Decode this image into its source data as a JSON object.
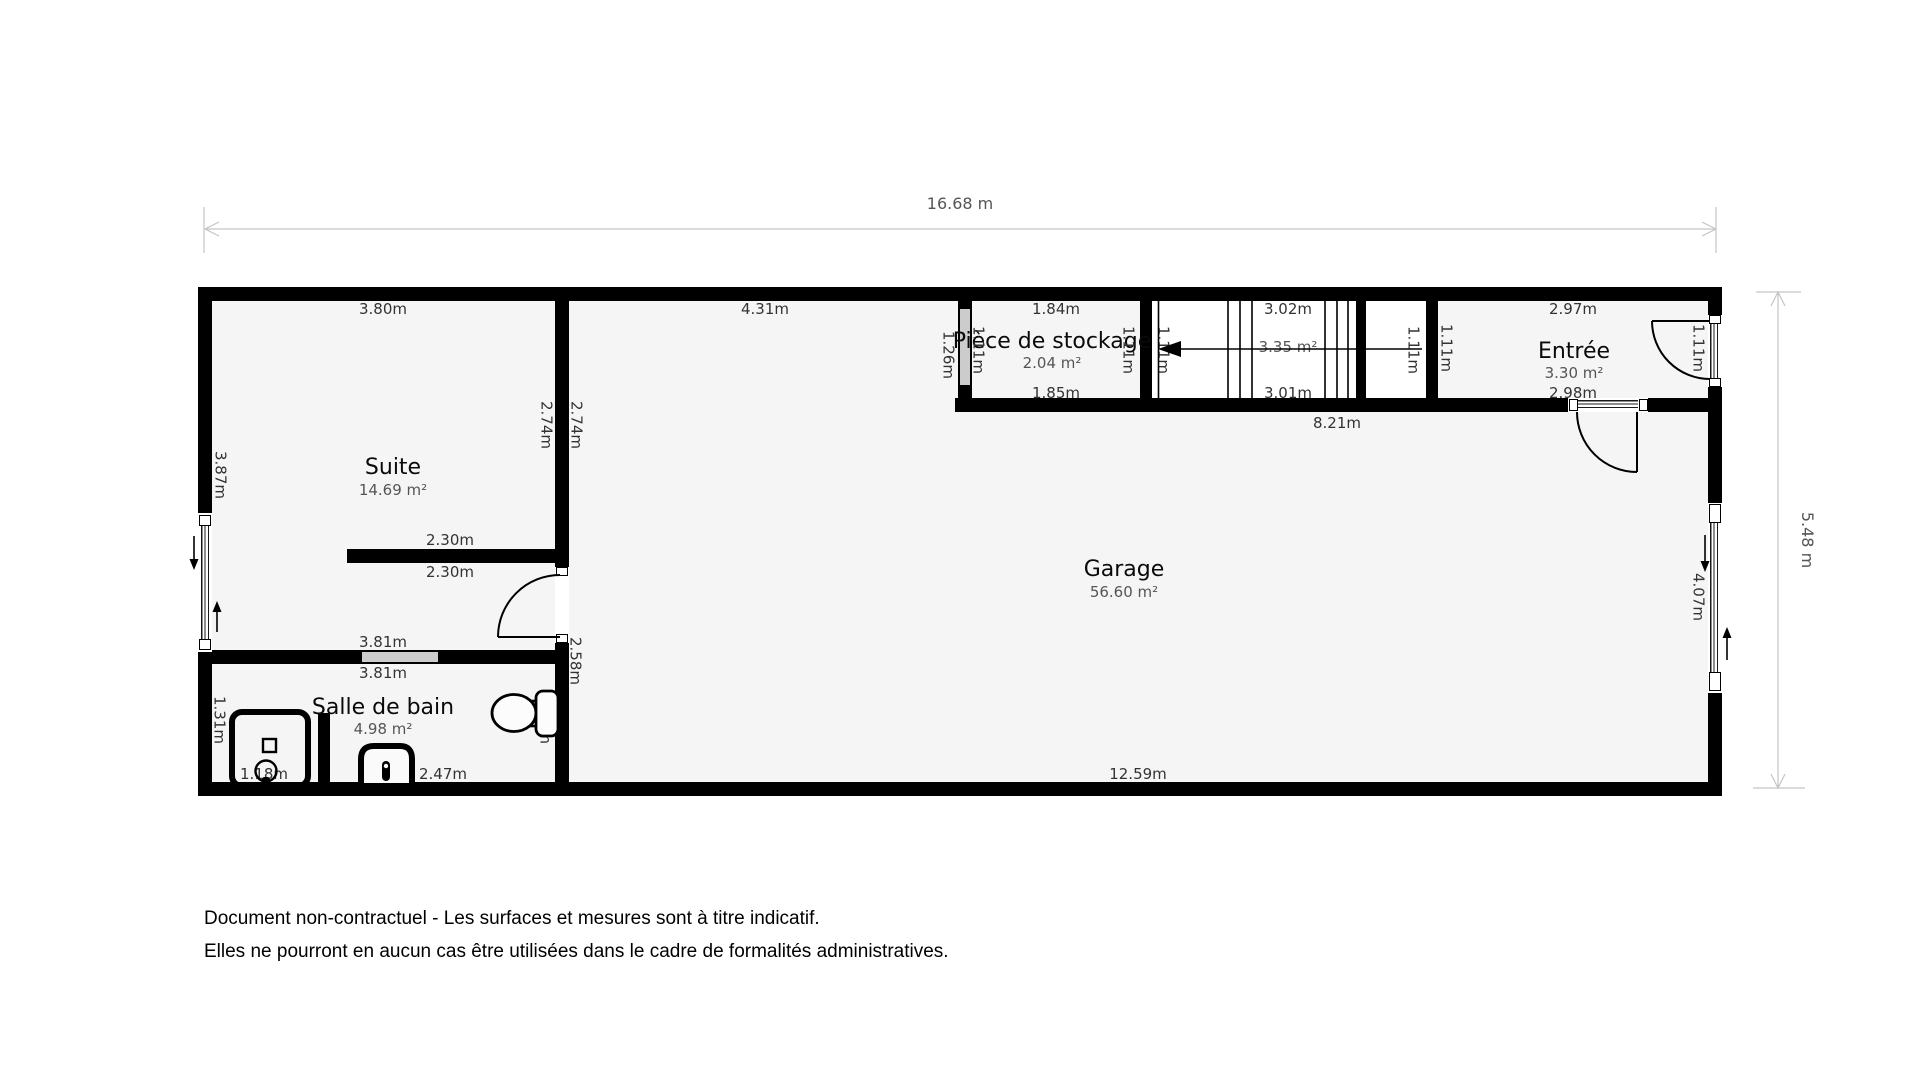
{
  "plan": {
    "overall": {
      "width_label": "16.68 m",
      "height_label": "5.48 m"
    },
    "rooms": {
      "suite": {
        "name": "Suite",
        "area": "14.69 m²",
        "dim_top": "3.80m",
        "dim_left": "3.87m",
        "dim_wall_suite_side": "2.74m",
        "dim_wall_garage_side": "2.74m",
        "dim_stub_top": "2.30m",
        "dim_stub_bottom": "2.30m"
      },
      "bathroom": {
        "name": "Salle de bain",
        "area": "4.98 m²",
        "dim_top_suite_side": "3.81m",
        "dim_top": "3.81m",
        "dim_left": "1.31m",
        "dim_right": "1.31m",
        "dim_bottom": "2.47m",
        "dim_shower": "1.18m"
      },
      "garage": {
        "name": "Garage",
        "area": "56.60 m²",
        "dim_top": "4.31m",
        "dim_bottom": "12.59m",
        "dim_left_lower": "2.58m",
        "dim_right": "4.07m",
        "dim_band_bottom": "8.21m"
      },
      "storage": {
        "name": "Pièce de stockage",
        "area": "2.04 m²",
        "dim_top": "1.84m",
        "dim_bottom": "1.85m",
        "dim_left_wall": "1.26m",
        "dim_left": "1.11m",
        "dim_right": "1.11m"
      },
      "stairs": {
        "area": "3.35 m²",
        "dim_top": "3.02m",
        "dim_bottom": "3.01m",
        "dim_left": "1.11m",
        "dim_right": "1.11m"
      },
      "entry": {
        "name": "Entrée",
        "area": "3.30 m²",
        "dim_top": "2.97m",
        "dim_bottom": "2.98m",
        "dim_left": "1.11m",
        "dim_right": "1.11m"
      }
    },
    "footer": {
      "line1": "Document non-contractuel - Les surfaces et mesures sont à titre indicatif.",
      "line2": "Elles ne pourront en aucun cas être utilisées dans le cadre de formalités administratives."
    }
  },
  "colors": {
    "wall": "#000000",
    "room_fill": "#f5f5f5",
    "stairs_fill": "#ffffff",
    "glass": "#cccccc",
    "dim_line": "#c5c5c5",
    "dim_text": "#555555",
    "label_text": "#333333",
    "room_name_text": "#0a0a0a"
  }
}
